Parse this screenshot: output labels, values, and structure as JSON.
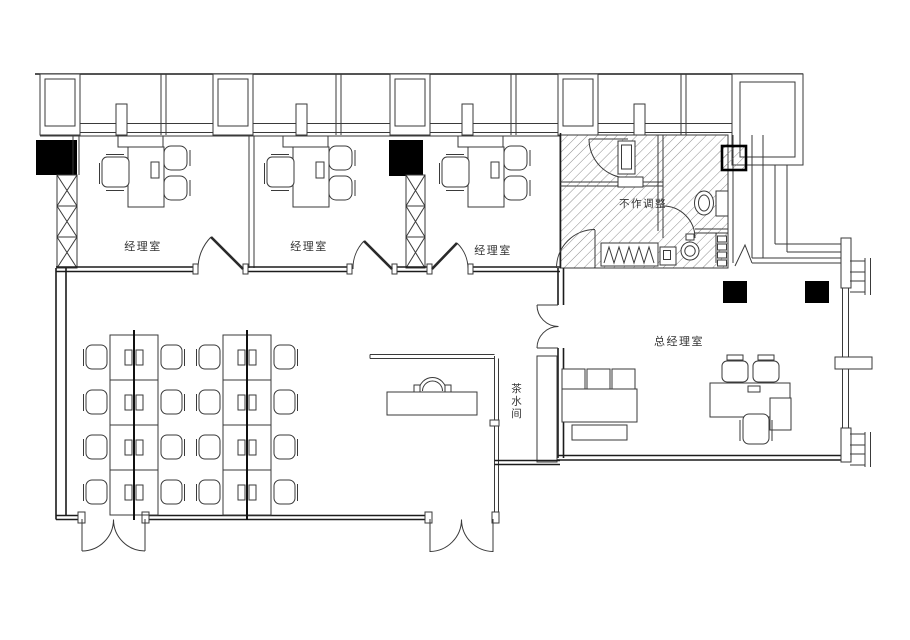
{
  "drawing": {
    "type": "office-floor-plan",
    "rooms": {
      "manager_office_1": "经理室",
      "manager_office_2": "经理室",
      "manager_office_3": "经理室",
      "restricted_area": "不作调整",
      "general_manager_office": "总经理室",
      "tea_room": "茶水间"
    }
  },
  "colors": {
    "paper": "#ffffff",
    "line": "#3a3a3a",
    "wall": "#1c1c1c",
    "solid_column": "#000000",
    "hatch_line": "#707070",
    "label_text": "#333333"
  }
}
